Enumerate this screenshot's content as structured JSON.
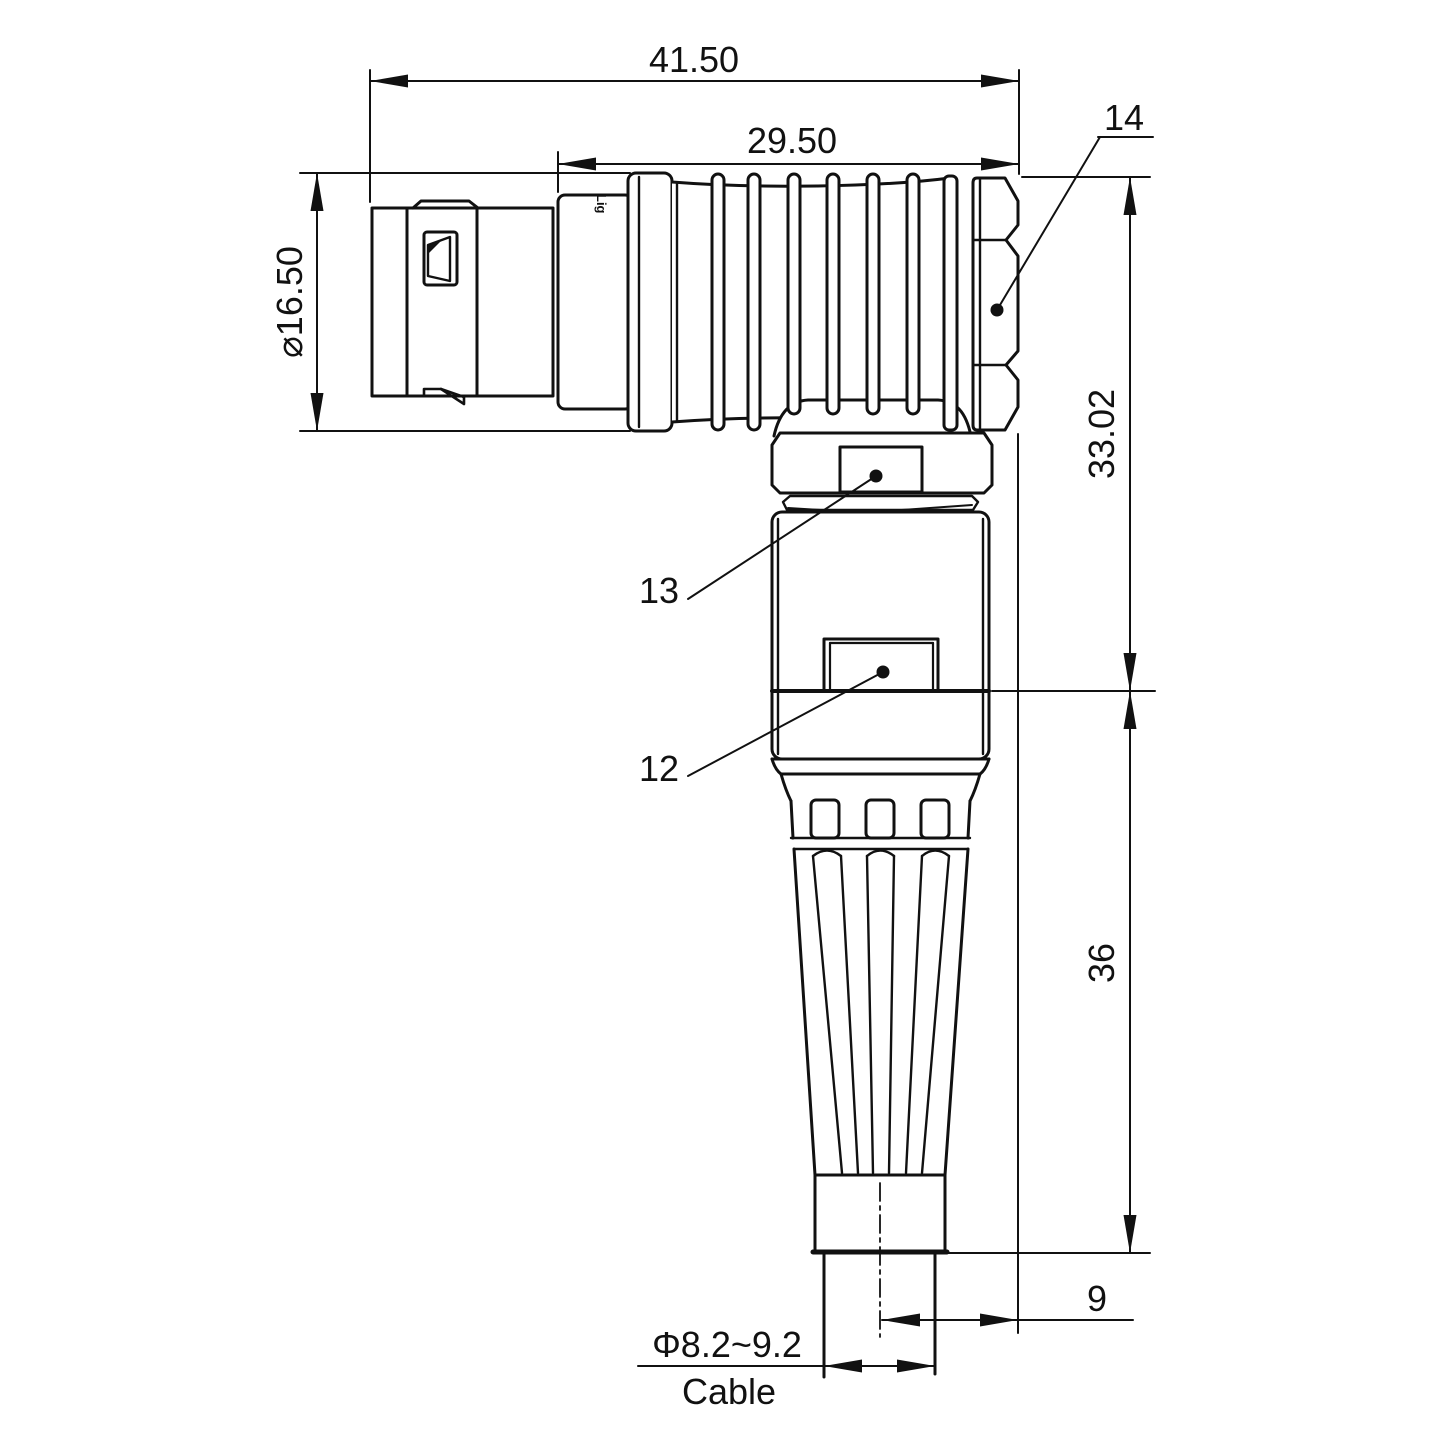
{
  "drawing": {
    "title": "Right-angle circular connector - dimensioned drawing",
    "line_color": "#111111",
    "background": "#ffffff",
    "watermark": {
      "text": "Lightany",
      "color": "#f5c2c2"
    },
    "shell_engraving": "Lig"
  },
  "dimensions": {
    "overall_length": "41.50",
    "rear_body_length": "29.50",
    "shell_diameter": "⌀16.50",
    "upper_height": "33.02",
    "lower_height": "36",
    "axis_offset": "9",
    "cable_diameter": "Φ8.2~9.2",
    "cable_label": "Cable"
  },
  "callouts": [
    {
      "id": "14",
      "target": "coupling-nut"
    },
    {
      "id": "13",
      "target": "collar-latch"
    },
    {
      "id": "12",
      "target": "body-latch"
    }
  ]
}
